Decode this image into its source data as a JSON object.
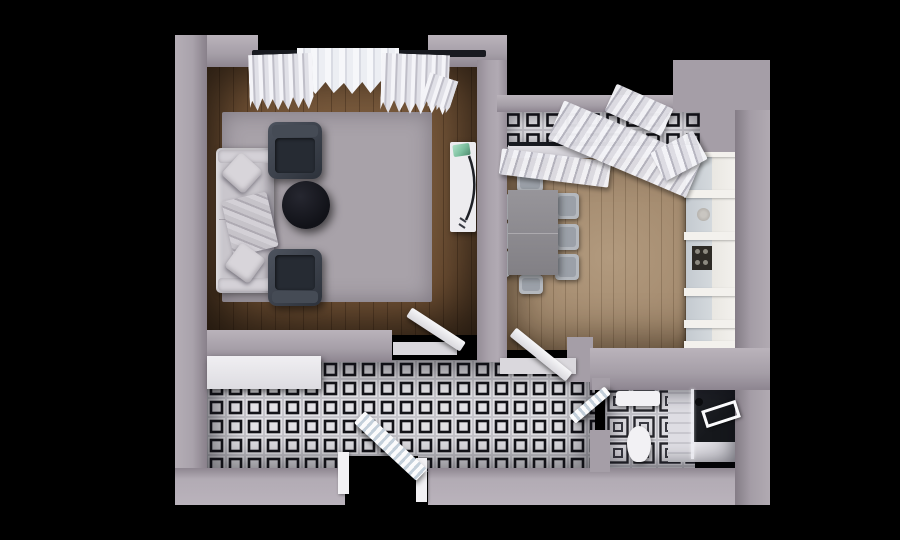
{
  "scene": {
    "description": "3D top-down architectural render of a one-bedroom apartment floor plan on a black background",
    "rooms": [
      {
        "id": "living-room",
        "floor": "dark wood planks",
        "furniture": [
          "corner-sofa",
          "pillows",
          "throw-blanket",
          "armchair-top",
          "armchair-bottom",
          "round-coffee-table",
          "area-rug",
          "tv-console",
          "plant",
          "window-curtains"
        ]
      },
      {
        "id": "dining-room",
        "floor": "light wood planks",
        "furniture": [
          "dining-table",
          "eight-chairs",
          "kitchen-cabinet-run",
          "stove",
          "sink",
          "window-sill",
          "slatted-curtains"
        ]
      },
      {
        "id": "balcony",
        "floor": "black-white checkered tiles",
        "furniture": [
          "curtain-drape"
        ]
      },
      {
        "id": "hallway",
        "floor": "black-white checkered tiles",
        "furniture": [
          "wardrobe-console",
          "entry-door-open",
          "interior-doors-open"
        ]
      },
      {
        "id": "bathroom",
        "floor": "black-white ornamental tiles",
        "furniture": [
          "sink",
          "toilet",
          "shower-enclosure",
          "towel-bar",
          "door-open"
        ]
      }
    ]
  },
  "palette": {
    "background": "#000000",
    "wall": "#a9a2ab",
    "floor-living": "#6e4f33",
    "floor-living-light": "#836445",
    "floor-dining": "#a1886c",
    "floor-dining-light": "#b29a7e",
    "rug": "#a8a2a9",
    "sofa": "#c9c6cc",
    "pillow": "#d8d5da",
    "armchair": "#3c424c",
    "armchair-seat": "#262b33",
    "coffee-table": "#111218",
    "tv-console": "#edecef",
    "plant": "#7bbf9e",
    "dining-table": "#8b898d",
    "chair": "#b4b8be",
    "kitchen": "#e6e3dd",
    "stove": "#2e2b26",
    "tile-white": "#e3e2e6",
    "tile-black": "#141419",
    "bath-tile": "#dddce1",
    "curtain": "#eef0f4",
    "rod": "#181a20",
    "door": "#f0eff2",
    "shower": "#16181c",
    "fixture": "#f2f1f4"
  }
}
